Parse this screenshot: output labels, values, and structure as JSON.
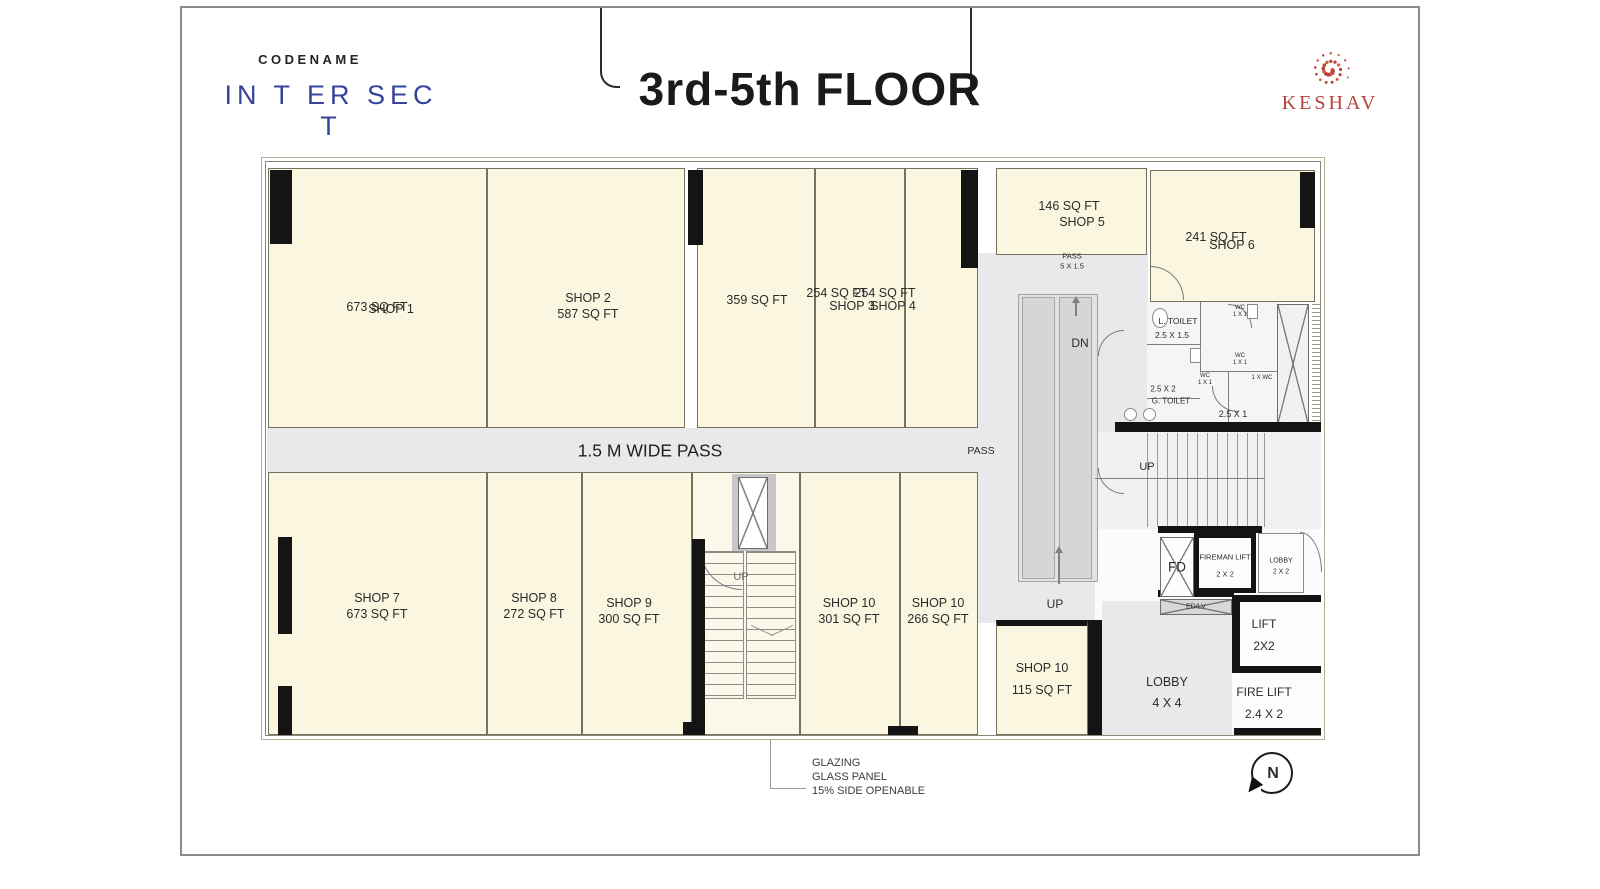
{
  "header": {
    "codename": "CODENAME",
    "project": "IN T ER SEC T",
    "floor_title": "3rd-5th FLOOR",
    "brand": "KESHAV"
  },
  "rooms": {
    "shop1": {
      "area": "673 SQ FT",
      "name": "SHOP 1"
    },
    "shop2": {
      "name": "SHOP 2",
      "area": "587 SQ FT"
    },
    "shop_359": {
      "area": "359 SQ FT"
    },
    "shop3": {
      "area": "254 SQ FT",
      "name": "SHOP 3"
    },
    "shop4": {
      "area": "254 SQ FT",
      "name": "SHOP 4"
    },
    "shop5": {
      "area": "146 SQ FT",
      "name": "SHOP 5"
    },
    "shop6": {
      "area": "241 SQ FT",
      "name": "SHOP 6"
    },
    "shop7": {
      "name": "SHOP 7",
      "area": "673 SQ FT"
    },
    "shop8": {
      "name": "SHOP 8",
      "area": "272 SQ FT"
    },
    "shop9": {
      "name": "SHOP 9",
      "area": "300 SQ FT"
    },
    "shop10_301": {
      "name": "SHOP 10",
      "area": "301 SQ FT"
    },
    "shop10_266": {
      "name": "SHOP 10",
      "area": "266 SQ FT"
    },
    "shop10_115": {
      "name": "SHOP 10",
      "area": "115 SQ FT"
    }
  },
  "circulation": {
    "wide_pass": "1.5 M WIDE PASS",
    "pass": "PASS",
    "pass_small": "PASS",
    "pass_small_size": "5 X 1.5",
    "dn": "DN",
    "up": "UP"
  },
  "toilets": {
    "l_toilet": "L. TOILET",
    "l_toilet_size": "2.5 X 1.5",
    "g_toilet": "G. TOILET",
    "g_toilet_size": "2.5 X 2",
    "wc": "WC",
    "wc_size": "1 X 1",
    "wc_alt": "1 X WC",
    "size_2_5x1": "2.5 X 1"
  },
  "core": {
    "fd": "FD",
    "edlv": "ED/LV",
    "fireman_lift": "FIREMAN LIFT",
    "fireman_lift_size": "2 X 2",
    "lobby_small": "LOBBY",
    "lobby_small_size": "2 X 2",
    "lift": "LIFT",
    "lift_size": "2X2",
    "fire_lift": "FIRE LIFT",
    "fire_lift_size": "2.4 X 2",
    "lobby_main": "LOBBY",
    "lobby_main_size": "4 X 4"
  },
  "notes": {
    "glazing_l1": "GLAZING",
    "glazing_l2": "GLASS PANEL",
    "glazing_l3": "15% SIDE OPENABLE",
    "north": "N"
  },
  "colors": {
    "accent_blue": "#35439b",
    "brand_red": "#b5423c",
    "shop_fill": "#faf6e0",
    "pass_fill": "#e9e9ec",
    "wall_black": "#141414"
  }
}
